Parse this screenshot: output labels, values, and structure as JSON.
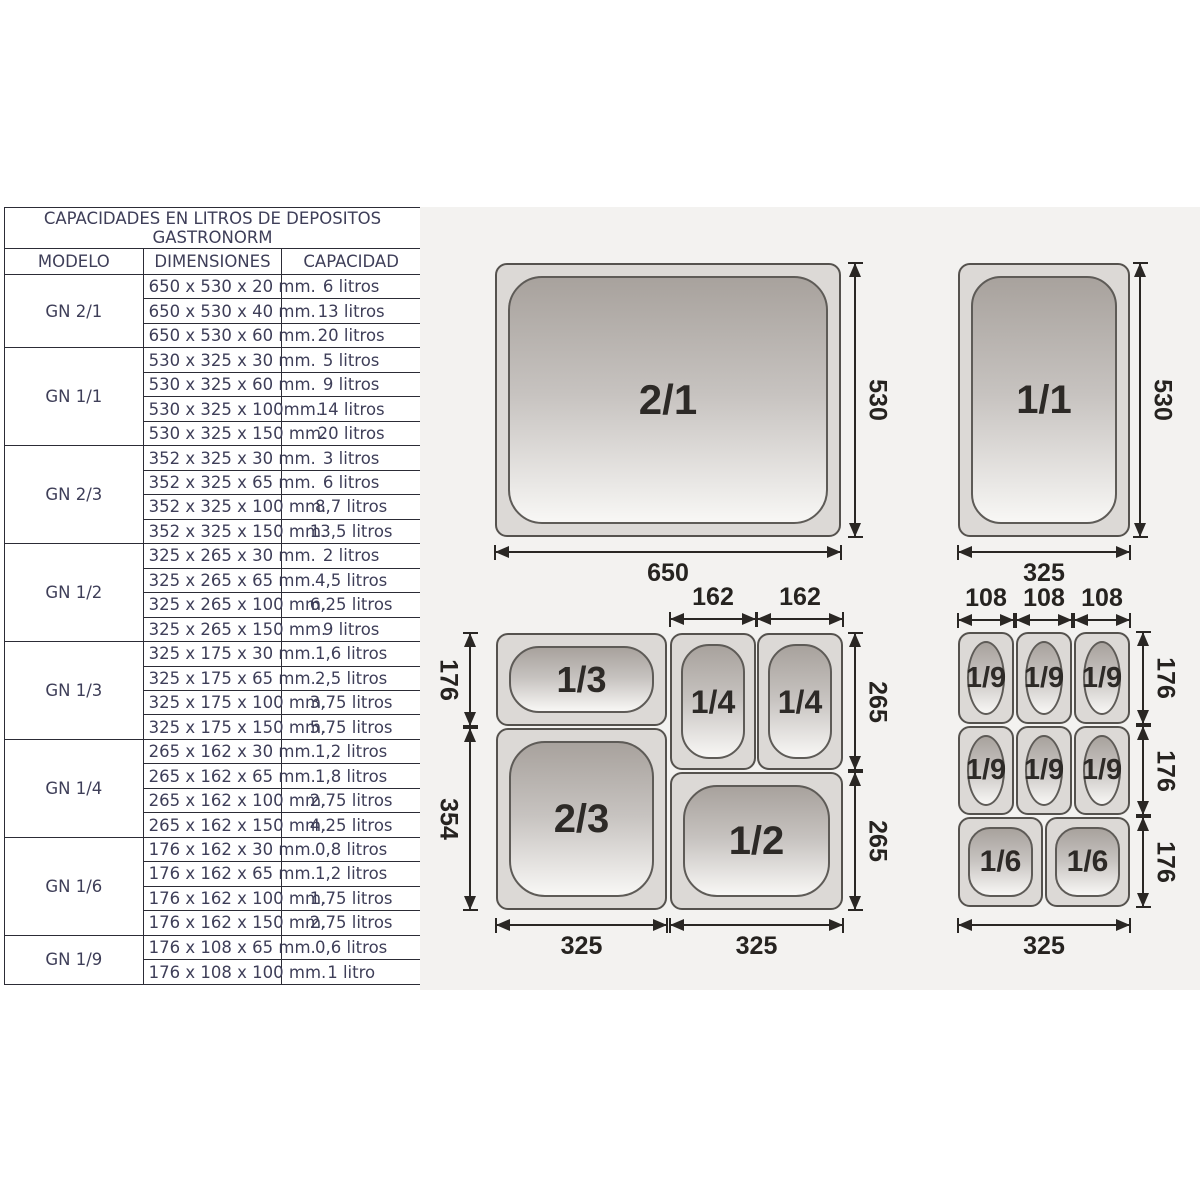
{
  "table": {
    "title": "CAPACIDADES EN LITROS DE DEPOSITOS",
    "subtitle": "GASTRONORM",
    "columns": [
      "MODELO",
      "DIMENSIONES",
      "CAPACIDAD"
    ],
    "groups": [
      {
        "model": "GN 2/1",
        "rows": [
          [
            "650 x 530 x 20 mm.",
            "6 litros"
          ],
          [
            "650 x 530 x 40 mm.",
            "13 litros"
          ],
          [
            "650 x 530 x 60 mm.",
            "20 litros"
          ]
        ]
      },
      {
        "model": "GN 1/1",
        "rows": [
          [
            "530 x 325 x 30 mm.",
            "5 litros"
          ],
          [
            "530 x 325 x 60 mm.",
            "9 litros"
          ],
          [
            "530 x 325 x 100mm.",
            "14 litros"
          ],
          [
            "530 x 325 x 150 mm.",
            "20 litros"
          ]
        ]
      },
      {
        "model": "GN 2/3",
        "rows": [
          [
            "352 x 325 x 30 mm.",
            "3 litros"
          ],
          [
            "352 x 325 x 65 mm.",
            "6 litros"
          ],
          [
            "352 x 325 x 100 mm.",
            "8,7 litros"
          ],
          [
            "352 x 325 x 150 mm.",
            "13,5 litros"
          ]
        ]
      },
      {
        "model": "GN 1/2",
        "rows": [
          [
            "325 x 265 x 30 mm.",
            "2 litros"
          ],
          [
            "325 x 265 x 65 mm.",
            "4,5 litros"
          ],
          [
            "325 x 265 x 100 mm.",
            "6,25 litros"
          ],
          [
            "325 x 265 x 150 mm.",
            "9 litros"
          ]
        ]
      },
      {
        "model": "GN 1/3",
        "rows": [
          [
            "325 x 175 x 30 mm.",
            "1,6 litros"
          ],
          [
            "325 x 175 x 65 mm.",
            "2,5 litros"
          ],
          [
            "325 x 175 x 100 mm.",
            "3,75 litros"
          ],
          [
            "325 x 175 x 150 mm.",
            "5,75 litros"
          ]
        ]
      },
      {
        "model": "GN 1/4",
        "rows": [
          [
            "265 x 162 x 30 mm.",
            "1,2 litros"
          ],
          [
            "265 x 162 x 65 mm.",
            "1,8 litros"
          ],
          [
            "265 x 162 x 100 mm.",
            "2,75 litros"
          ],
          [
            "265 x 162 x 150 mm.",
            "4,25 litros"
          ]
        ]
      },
      {
        "model": "GN 1/6",
        "rows": [
          [
            "176 x 162 x 30 mm.",
            "0,8 litros"
          ],
          [
            "176 x 162 x 65 mm.",
            "1,2 litros"
          ],
          [
            "176 x 162 x 100 mm.",
            "1,75 litros"
          ],
          [
            "176 x 162 x 150 mm.",
            "2,75 litros"
          ]
        ]
      },
      {
        "model": "GN 1/9",
        "rows": [
          [
            "176 x 108 x 65 mm.",
            "0,6 litros"
          ],
          [
            "176 x 108 x 100 mm.",
            "1 litro"
          ]
        ]
      }
    ]
  },
  "diagram": {
    "pans": {
      "gn21": "2/1",
      "gn11": "1/1",
      "gn13": "1/3",
      "gn14": "1/4",
      "gn23": "2/3",
      "gn12": "1/2",
      "gn19": "1/9",
      "gn16": "1/6"
    },
    "dims": {
      "d650": "650",
      "d530": "530",
      "d325": "325",
      "d162": "162",
      "d176": "176",
      "d354": "354",
      "d265": "265",
      "d108": "108"
    }
  }
}
